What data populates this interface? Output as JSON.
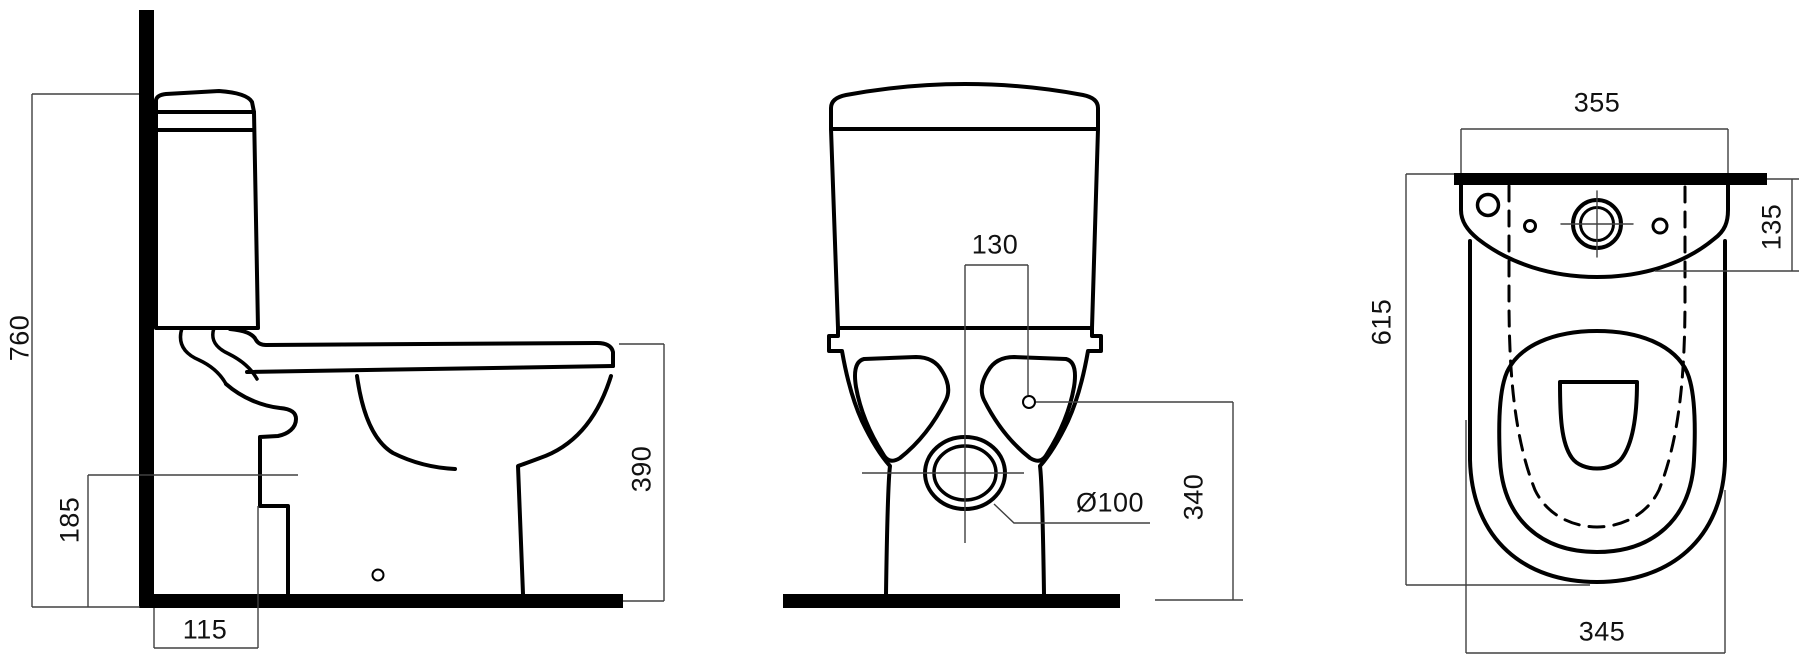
{
  "drawing": {
    "background_color": "#ffffff",
    "outline_color": "#000000",
    "dim_line_color": "#404040",
    "dimensions": {
      "dim_760": {
        "text": "760",
        "orientation": "vertical",
        "view": "side"
      },
      "dim_185": {
        "text": "185",
        "orientation": "vertical",
        "view": "side"
      },
      "dim_115": {
        "text": "115",
        "orientation": "horizontal",
        "view": "side"
      },
      "dim_390": {
        "text": "390",
        "orientation": "vertical",
        "view": "side"
      },
      "dim_130": {
        "text": "130",
        "orientation": "horizontal",
        "view": "front"
      },
      "dim_o100": {
        "text": "Ø100",
        "orientation": "horizontal",
        "view": "front"
      },
      "dim_340": {
        "text": "340",
        "orientation": "vertical",
        "view": "front"
      },
      "dim_355": {
        "text": "355",
        "orientation": "horizontal",
        "view": "top"
      },
      "dim_135": {
        "text": "135",
        "orientation": "vertical",
        "view": "top"
      },
      "dim_615": {
        "text": "615",
        "orientation": "vertical",
        "view": "top"
      },
      "dim_345": {
        "text": "345",
        "orientation": "horizontal",
        "view": "top"
      }
    }
  }
}
